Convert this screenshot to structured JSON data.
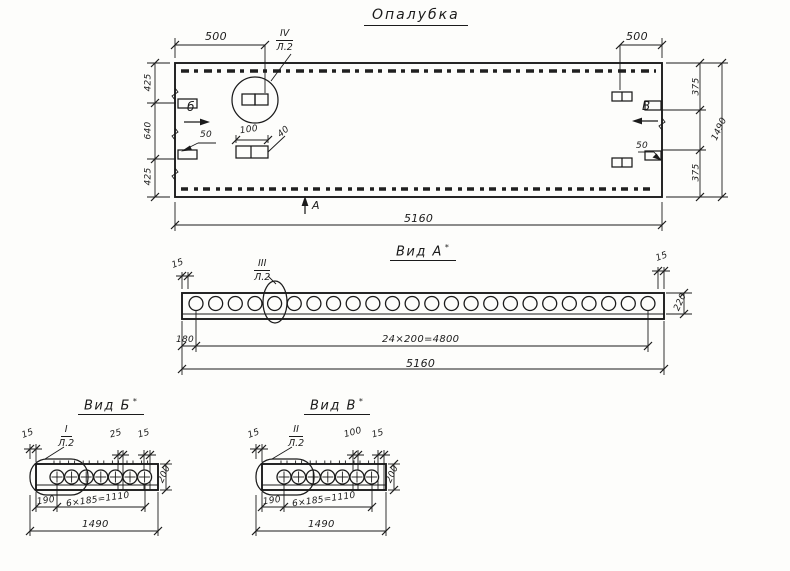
{
  "sheet": {
    "bg": "#fdfdfb",
    "ink": "#1b1b1b"
  },
  "title": "Опалубка",
  "plan": {
    "callout": {
      "num": "IV",
      "sheet": "Л.2"
    },
    "marker_b": "б",
    "marker_v": "В",
    "marker_a": "А",
    "dims": {
      "top_left": "500",
      "top_right": "500",
      "left_top": "425",
      "left_mid": "640",
      "left_bottom": "425",
      "right_top": "375",
      "right_overall": "1490",
      "right_bottom": "375",
      "bottom_overall": "5160",
      "cleat_left": "50",
      "cleat_right": "50",
      "detail_width": "100",
      "detail_height": "40"
    }
  },
  "view_a": {
    "title": "Вид А",
    "mark": "*",
    "callout": {
      "num": "III",
      "sheet": "Л.2"
    },
    "holes": 24,
    "dims": {
      "end_left": "15",
      "end_right": "15",
      "height": "220",
      "first": "180",
      "spacing": "24×200=4800",
      "overall": "5160"
    }
  },
  "view_b": {
    "title": "Вид Б",
    "mark": "*",
    "callout": {
      "num": "I",
      "sheet": "Л.2"
    },
    "holes": 7,
    "dims": {
      "end_left": "15",
      "slot": "25",
      "end_right": "15",
      "height": "200",
      "first": "190",
      "spacing": "6×185=1110",
      "overall": "1490"
    }
  },
  "view_v": {
    "title": "Вид В",
    "mark": "*",
    "callout": {
      "num": "II",
      "sheet": "Л.2"
    },
    "holes": 7,
    "dims": {
      "end_left": "15",
      "slot": "100",
      "end_right": "15",
      "height": "200",
      "first": "190",
      "spacing": "6×185=1110",
      "overall": "1490"
    }
  }
}
